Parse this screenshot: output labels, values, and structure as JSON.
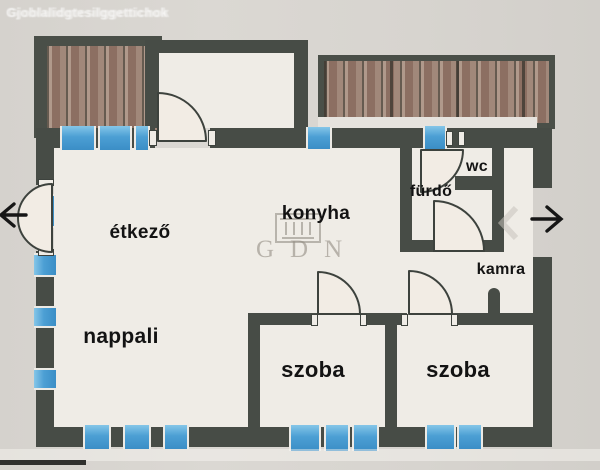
{
  "ghost_watermark_top": "Gjoblalidgtesilggettichok",
  "rooms": [
    {
      "id": "etkezo",
      "label": "étkező"
    },
    {
      "id": "konyha",
      "label": "konyha"
    },
    {
      "id": "nappali",
      "label": "nappali"
    },
    {
      "id": "szoba_left",
      "label": "szoba"
    },
    {
      "id": "szoba_right",
      "label": "szoba"
    },
    {
      "id": "wc",
      "label": "wc"
    },
    {
      "id": "furdo",
      "label": "fürdő"
    },
    {
      "id": "kamra",
      "label": "kamra"
    }
  ],
  "watermark": {
    "text": "GDN",
    "logo": "gdn-building-logo"
  },
  "arrows": {
    "left": "exit-arrow-left",
    "right": "exit-arrow-right"
  },
  "ghost_texts": [
    {
      "text": "esnpausze"
    },
    {
      "text": "in egyeslit"
    },
    {
      "text": "KÖFDSZNI 84 m2"
    },
    {
      "text": "se ovi"
    },
    {
      "text": "Az svenojv zjsucne vv"
    },
    {
      "text": "leguaját"
    }
  ],
  "colors": {
    "wall": "#474c46",
    "window_blue": "#4c9fd4",
    "deck_brown": "#997a6c",
    "paper": "#efece6",
    "background": "#d7d4cf",
    "watermark_gray": "#938d83"
  }
}
